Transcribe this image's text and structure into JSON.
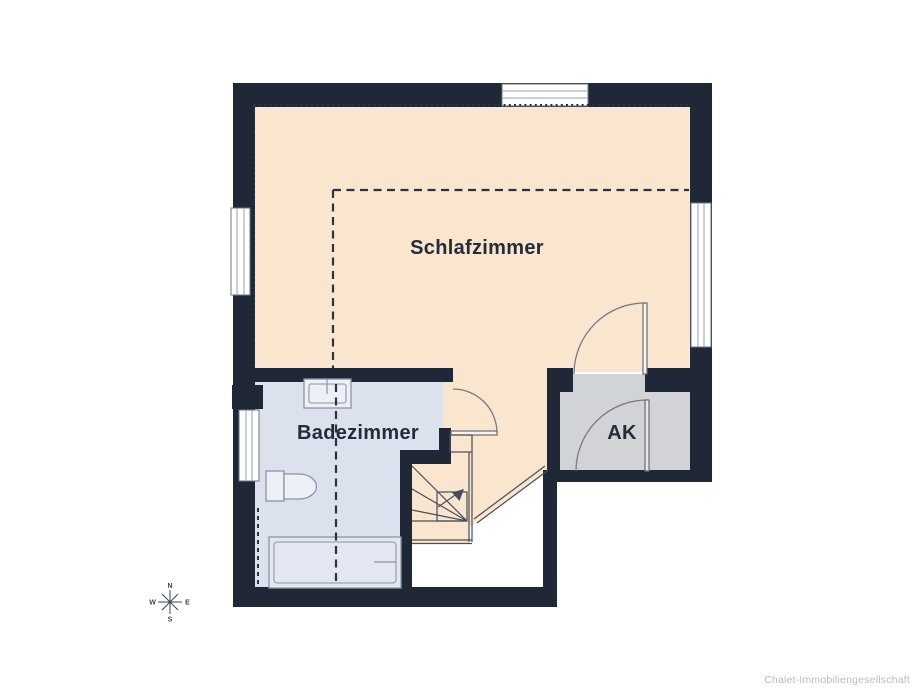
{
  "plan": {
    "type": "floor-plan",
    "rooms": [
      {
        "name": "schlafzimmer",
        "label": "Schlafzimmer"
      },
      {
        "name": "badezimmer",
        "label": "Badezimmer"
      },
      {
        "name": "ak",
        "label": "AK"
      }
    ],
    "features": [
      "winder-staircase",
      "3 door swings",
      "4 windows",
      "knee-wall dashed lines"
    ],
    "compass": {
      "north": "N",
      "east": "E",
      "south": "S",
      "west": "W"
    },
    "watermark": "Chalet-Immobiliengesellschaft",
    "colors": {
      "wall": "#202837",
      "bedroom_floor": "#fae6cf",
      "bathroom_floor": "#dce2ed",
      "storage_floor": "#d2d3d7",
      "stair_line": "#474e5c",
      "door_line": "#757a85",
      "fixture_line": "#8e94a2",
      "dash_line": "#2b3340",
      "label_text": "#242c3a",
      "watermark_text": "#bcbcbc"
    }
  }
}
